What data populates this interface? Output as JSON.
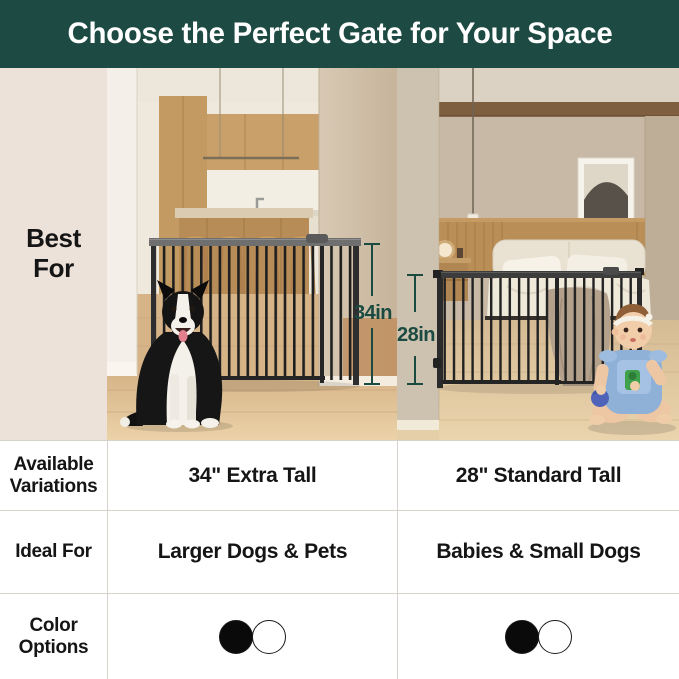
{
  "header": {
    "title": "Choose the Perfect Gate for Your Space"
  },
  "side_panel": {
    "best_for_label": "Best For"
  },
  "table": {
    "variations_label": "Available Variations",
    "ideal_label": "Ideal For",
    "colors_label": "Color Options"
  },
  "gates": {
    "left": {
      "height_label": "34in",
      "variation": "34\" Extra Tall",
      "ideal_for": "Larger Dogs & Pets",
      "color_options": [
        {
          "name": "black",
          "hex": "#0a0a0a"
        },
        {
          "name": "white",
          "hex": "#ffffff"
        }
      ]
    },
    "right": {
      "height_label": "28in",
      "variation": "28\" Standard Tall",
      "ideal_for": "Babies & Small Dogs",
      "color_options": [
        {
          "name": "black",
          "hex": "#0a0a0a"
        },
        {
          "name": "white",
          "hex": "#ffffff"
        }
      ]
    }
  },
  "theme": {
    "banner_green": "#1d4a43",
    "panel_cream": "#ece2d9",
    "annotation_green": "#1b4a41"
  }
}
